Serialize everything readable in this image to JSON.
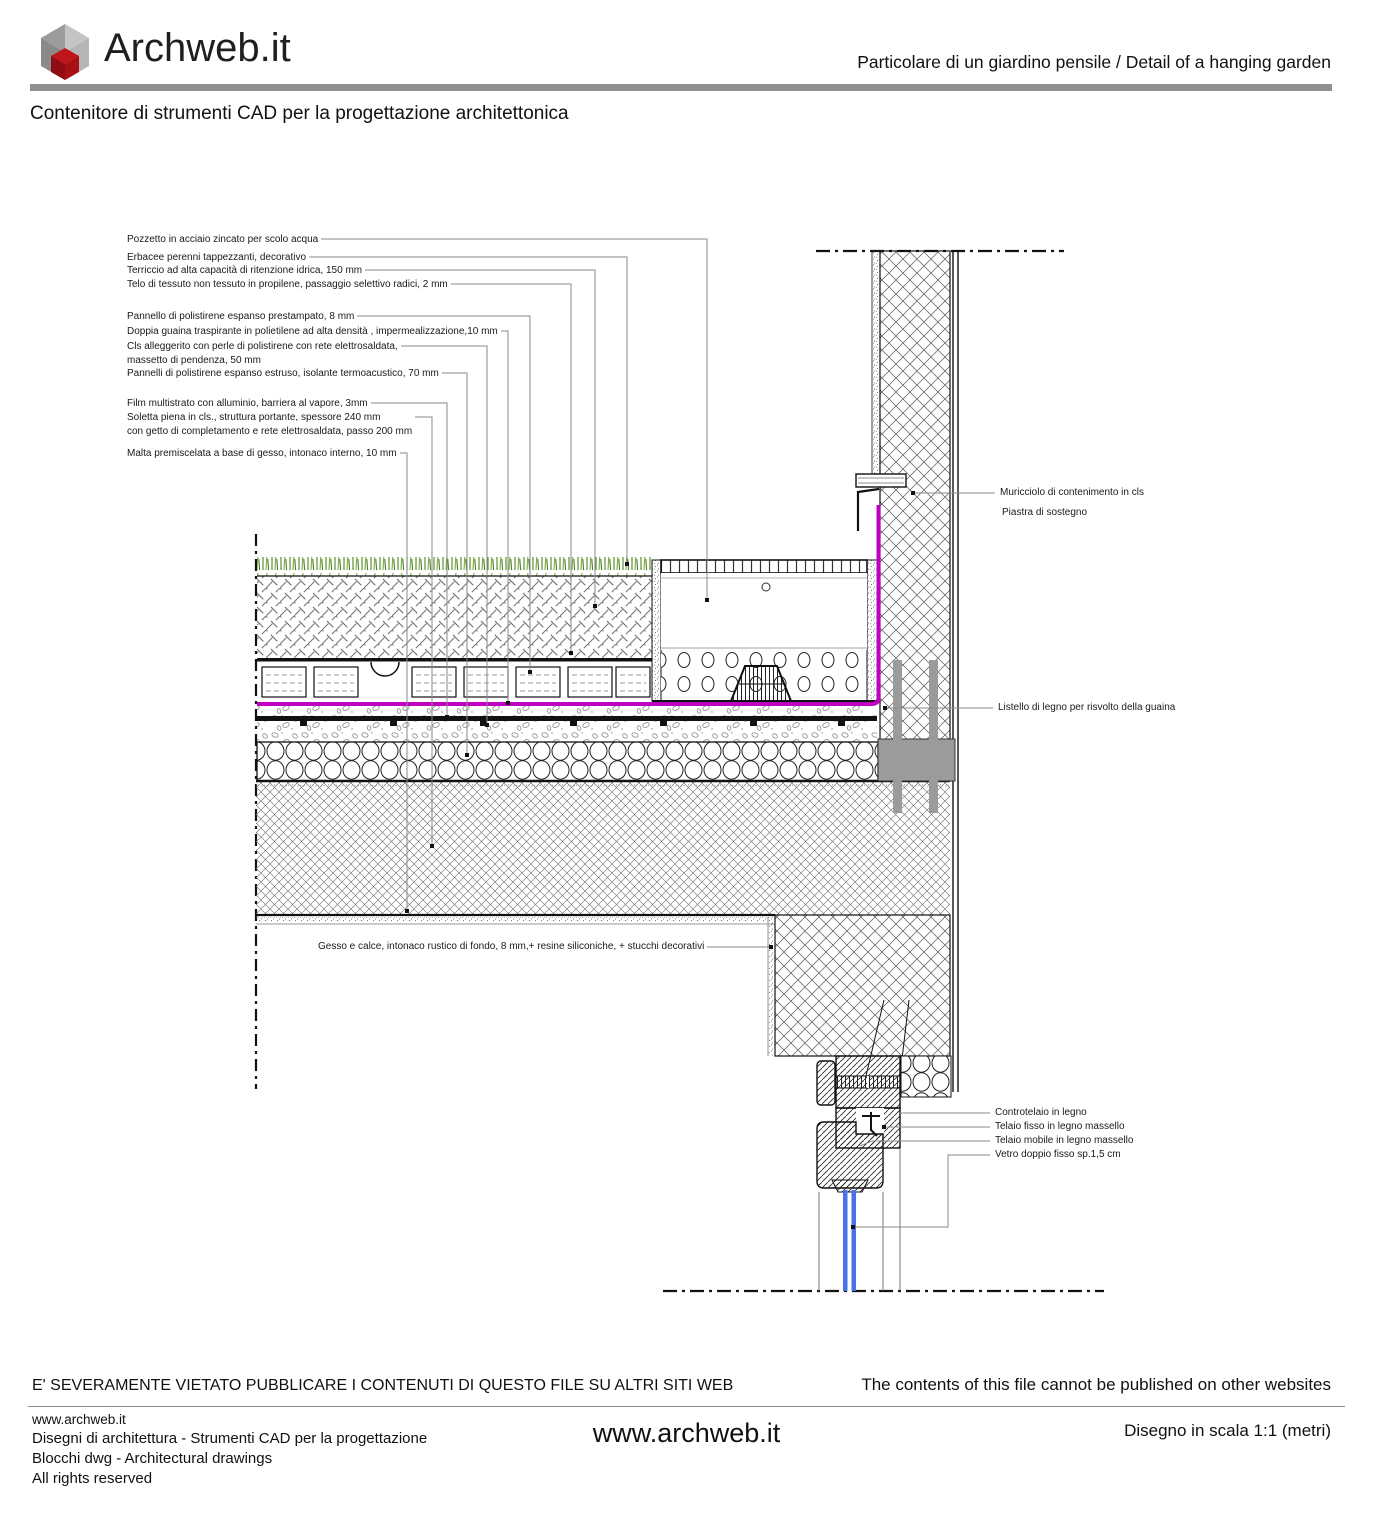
{
  "header": {
    "logo_text": "Archweb.it",
    "subtitle_right": "Particolare di un giardino pensile  /  Detail of a hanging garden",
    "tagline": "Contenitore di strumenti CAD per la progettazione architettonica"
  },
  "drawing": {
    "left_labels": [
      {
        "text": "Pozzetto in acciaio zincato per scolo acqua"
      },
      {
        "text": "Erbacee perenni tappezzanti, decorativo"
      },
      {
        "text": "Terriccio ad alta capacità di ritenzione idrica, 150 mm"
      },
      {
        "text": "Telo di tessuto non tessuto in propilene, passaggio selettivo radici, 2 mm"
      },
      {
        "text": "Pannello di polistirene espanso prestampato, 8 mm"
      },
      {
        "text": "Doppia guaina traspirante in polietilene ad alta densità , impermealizzazione,10 mm"
      },
      {
        "text": "Cls alleggerito con perle di polistirene con rete elettrosaldata,\nmassetto di pendenza, 50 mm"
      },
      {
        "text": "Pannelli di polistirene espanso estruso, isolante termoacustico, 70 mm"
      },
      {
        "text": "Film multistrato con alluminio, barriera al vapore, 3mm"
      },
      {
        "text": "Soletta piena in cls., struttura portante, spessore 240 mm\ncon getto di completamento e rete elettrosaldata, passo 200 mm"
      },
      {
        "text": "Malta premiscelata a base di gesso, intonaco interno, 10 mm"
      }
    ],
    "right_labels": [
      {
        "text": "Muricciolo di contenimento in cls"
      },
      {
        "text": "Piastra di sostegno"
      },
      {
        "text": "Listello di legno per risvolto della guaina"
      },
      {
        "text": "Controtelaio in legno"
      },
      {
        "text": "Telaio fisso in legno massello"
      },
      {
        "text": "Telaio mobile in legno massello"
      },
      {
        "text": "Vetro doppio fisso sp.1,5 cm"
      }
    ],
    "interior_label": "Gesso e calce, intonaco rustico di fondo, 8 mm,+ resine siliconiche, + stucchi decorativi"
  },
  "footer": {
    "notice_it": "E' SEVERAMENTE VIETATO PUBBLICARE I CONTENUTI DI QUESTO FILE SU ALTRI SITI WEB",
    "notice_en": "The contents of this file cannot be published on other websites",
    "site_small": "www.archweb.it",
    "line_disegni": "Disegni di architettura - Strumenti CAD  per la progettazione",
    "line_blocchi": "Blocchi dwg - Architectural drawings",
    "line_rights": "All rights reserved",
    "site_center": "www.archweb.it",
    "scale_note": "Disegno in scala 1:1 (metri)"
  },
  "colors": {
    "accent_red": "#b01116",
    "membrane_magenta": "#c000c0",
    "glass_blue": "#4a72e8",
    "rule_gray": "#8f8f8f",
    "steel_gray": "#9b9b9b"
  }
}
